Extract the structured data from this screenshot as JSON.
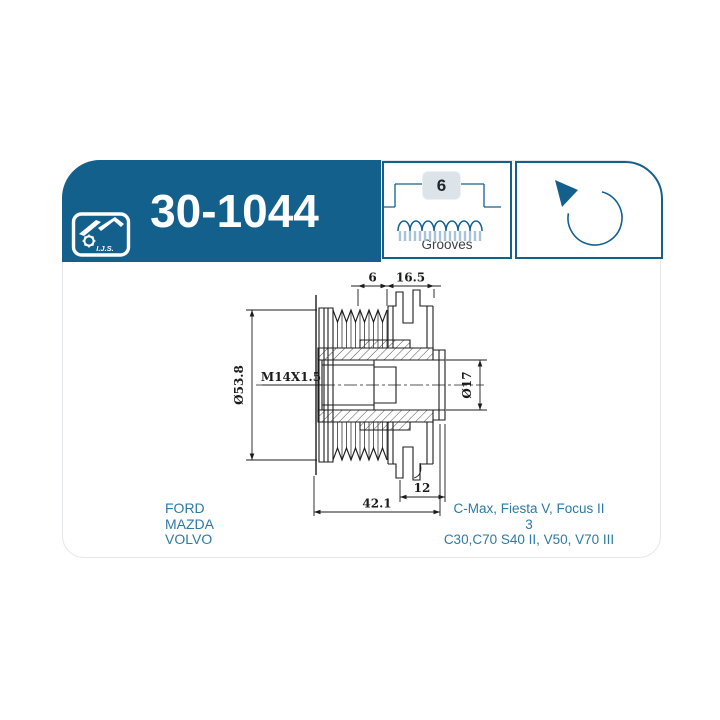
{
  "card": {
    "part_number": "30-1044",
    "logo": {
      "text": "I.J.S."
    },
    "grooves": {
      "count": "6",
      "label": "Grooves"
    },
    "rotation": {
      "direction": "counter-clockwise"
    }
  },
  "drawing": {
    "dimensions": {
      "groove_section_width": "6",
      "front_section_length": "16.5",
      "outer_diameter": "Ø53.8",
      "thread": "M14X1.5",
      "bore_diameter": "Ø17",
      "cap_length": "12",
      "overall_length": "42.1"
    }
  },
  "applications": {
    "brands": [
      "FORD",
      "MAZDA",
      "VOLVO"
    ],
    "models": [
      "C-Max, Fiesta V, Focus II",
      "3",
      "C30,C70 S40 II, V50, V70 III"
    ]
  },
  "colors": {
    "brand_blue": "#14608d",
    "application_text_blue": "#2e7aa4",
    "badge_background": "#dce3e9",
    "stripe_blue": "#a9c4d8",
    "drawing_line": "#1c1c1c"
  }
}
